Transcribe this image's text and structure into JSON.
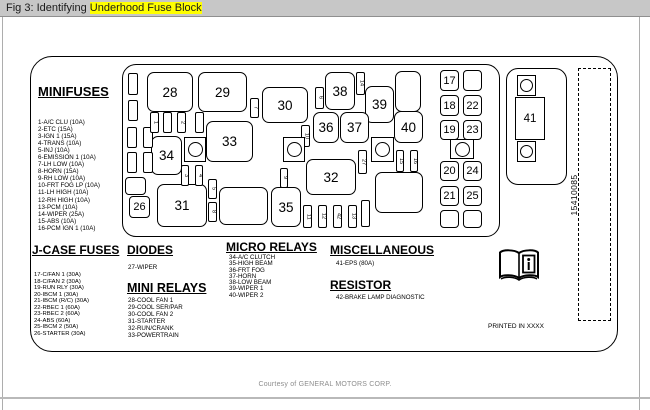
{
  "title_bar": {
    "prefix": "Fig 3: Identifying ",
    "highlight": "Underhood Fuse Block",
    "highlight_color": "#ffff00",
    "bar_color": "#c7c7c7"
  },
  "footer": {
    "courtesy": "Courtesy of GENERAL MOTORS CORP."
  },
  "diagram": {
    "part_number": "15410085",
    "printed_note": "PRINTED IN XXXX",
    "book_icon": "owners-manual-info-icon",
    "stroke_color": "#000000",
    "sections": {
      "minifuses": {
        "heading": "MINIFUSES",
        "items": [
          "1-A/C CLU (10A)",
          "2-ETC (15A)",
          "3-IGN 1 (15A)",
          "4-TRANS (10A)",
          "5-INJ (10A)",
          "6-EMISSION 1 (10A)",
          "7-LH LOW (10A)",
          "8-HORN (15A)",
          "9-RH LOW (10A)",
          "10-FRT FOG LP (10A)",
          "11-LH HIGH (10A)",
          "12-RH HIGH (10A)",
          "13-PCM (10A)",
          "14-WIPER (25A)",
          "15-ABS (10A)",
          "16-PCM IGN 1 (10A)"
        ]
      },
      "jcase": {
        "heading": "J-CASE FUSES",
        "items": [
          "17-C/FAN 1 (30A)",
          "18-C/FAN 2 (30A)",
          "19-RUN RLY (30A)",
          "20-IBCM 1 (30A)",
          "21-IBCM (R/C) (30A)",
          "22-RBEC 1 (60A)",
          "23-RBEC 2 (60A)",
          "24-ABS (60A)",
          "25-IBCM 2 (50A)",
          "26-STARTER (30A)"
        ]
      },
      "diodes": {
        "heading": "DIODES",
        "items": [
          "27-WIPER"
        ]
      },
      "mini_relays": {
        "heading": "MINI RELAYS",
        "items": [
          "28-COOL FAN 1",
          "29-COOL SER/PAR",
          "30-COOL FAN 2",
          "31-STARTER",
          "32-RUN/CRANK",
          "33-POWERTRAIN"
        ]
      },
      "micro_relays": {
        "heading": "MICRO RELAYS",
        "items": [
          "34-A/C CLUTCH",
          "35-HIGH BEAM",
          "36-FRT FOG",
          "37-HORN",
          "38-LOW BEAM",
          "39-WIPER 1",
          "40-WIPER 2"
        ]
      },
      "misc": {
        "heading": "MISCELLANEOUS",
        "items": [
          "41-EPS (80A)"
        ]
      },
      "resistor": {
        "heading": "RESISTOR",
        "items": [
          "42-BRAKE LAMP DIAGNOSTIC"
        ]
      }
    },
    "block": {
      "mega_label": "41",
      "cells": [
        {
          "label": "28",
          "box": [
            147,
            72,
            46,
            40
          ]
        },
        {
          "label": "29",
          "box": [
            198,
            72,
            49,
            40
          ]
        },
        {
          "label": "30",
          "box": [
            262,
            87,
            46,
            36
          ]
        },
        {
          "label": "38",
          "box": [
            325,
            72,
            30,
            38
          ]
        },
        {
          "label": "39",
          "box": [
            365,
            86,
            29,
            37
          ]
        },
        {
          "label": "",
          "box": [
            395,
            71,
            26,
            41
          ]
        },
        {
          "label": "36",
          "box": [
            313,
            112,
            26,
            31
          ]
        },
        {
          "label": "37",
          "box": [
            340,
            112,
            29,
            31
          ]
        },
        {
          "label": "40",
          "box": [
            394,
            111,
            29,
            32
          ]
        },
        {
          "label": "33",
          "box": [
            206,
            121,
            47,
            41
          ]
        },
        {
          "label": "34",
          "box": [
            151,
            136,
            31,
            39
          ]
        },
        {
          "label": "32",
          "box": [
            306,
            159,
            50,
            36
          ]
        },
        {
          "label": "31",
          "box": [
            157,
            184,
            50,
            43
          ]
        },
        {
          "label": "",
          "box": [
            219,
            187,
            49,
            38
          ]
        },
        {
          "label": "35",
          "box": [
            271,
            187,
            30,
            40
          ]
        },
        {
          "label": "",
          "box": [
            375,
            172,
            48,
            41
          ]
        },
        {
          "label": "",
          "box": [
            125,
            177,
            21,
            18
          ],
          "s": 1
        },
        {
          "label": "26",
          "box": [
            129,
            196,
            21,
            22
          ],
          "s": 1
        },
        {
          "label": "17",
          "box": [
            440,
            70,
            19,
            21
          ],
          "s": 1
        },
        {
          "label": "",
          "box": [
            463,
            70,
            19,
            21
          ],
          "s": 1
        },
        {
          "label": "18",
          "box": [
            440,
            95,
            19,
            21
          ],
          "s": 1
        },
        {
          "label": "22",
          "box": [
            463,
            95,
            19,
            21
          ],
          "s": 1
        },
        {
          "label": "19",
          "box": [
            440,
            120,
            19,
            20
          ],
          "s": 1
        },
        {
          "label": "23",
          "box": [
            463,
            120,
            19,
            20
          ],
          "s": 1
        },
        {
          "label": "20",
          "box": [
            440,
            161,
            19,
            20
          ],
          "s": 1
        },
        {
          "label": "24",
          "box": [
            463,
            161,
            19,
            20
          ],
          "s": 1
        },
        {
          "label": "21",
          "box": [
            440,
            186,
            19,
            20
          ],
          "s": 1
        },
        {
          "label": "25",
          "box": [
            463,
            186,
            19,
            20
          ],
          "s": 1
        },
        {
          "label": "",
          "box": [
            440,
            210,
            19,
            18
          ],
          "s": 1
        },
        {
          "label": "",
          "box": [
            463,
            210,
            19,
            18
          ],
          "s": 1
        }
      ],
      "small_fuses": [
        {
          "label": "",
          "box": [
            128,
            73,
            10,
            22
          ]
        },
        {
          "label": "",
          "box": [
            128,
            100,
            10,
            21
          ]
        },
        {
          "label": "",
          "box": [
            127,
            127,
            10,
            21
          ]
        },
        {
          "label": "",
          "box": [
            143,
            127,
            10,
            21
          ]
        },
        {
          "label": "",
          "box": [
            127,
            152,
            10,
            21
          ]
        },
        {
          "label": "",
          "box": [
            143,
            152,
            10,
            21
          ]
        },
        {
          "label": "1",
          "box": [
            150,
            112,
            9,
            21
          ]
        },
        {
          "label": "",
          "box": [
            163,
            112,
            9,
            21
          ]
        },
        {
          "label": "2",
          "box": [
            177,
            112,
            9,
            21
          ]
        },
        {
          "label": "",
          "box": [
            195,
            112,
            9,
            21
          ]
        },
        {
          "label": "7",
          "box": [
            250,
            98,
            9,
            20
          ]
        },
        {
          "label": "6",
          "box": [
            315,
            87,
            9,
            22
          ]
        },
        {
          "label": "14",
          "box": [
            356,
            72,
            9,
            23
          ]
        },
        {
          "label": "10",
          "box": [
            301,
            125,
            9,
            22
          ]
        },
        {
          "label": "3",
          "box": [
            181,
            165,
            8,
            21
          ]
        },
        {
          "label": "4",
          "box": [
            195,
            165,
            8,
            21
          ]
        },
        {
          "label": "5",
          "box": [
            208,
            179,
            9,
            20
          ]
        },
        {
          "label": "8",
          "box": [
            208,
            202,
            9,
            20
          ]
        },
        {
          "label": "9",
          "box": [
            280,
            168,
            8,
            20
          ]
        },
        {
          "label": "27",
          "box": [
            358,
            150,
            9,
            24
          ]
        },
        {
          "label": "15",
          "box": [
            396,
            150,
            8,
            22
          ]
        },
        {
          "label": "16",
          "box": [
            410,
            150,
            8,
            22
          ]
        },
        {
          "label": "11",
          "box": [
            303,
            205,
            9,
            23
          ]
        },
        {
          "label": "12",
          "box": [
            318,
            205,
            9,
            23
          ]
        },
        {
          "label": "42",
          "box": [
            333,
            205,
            9,
            23
          ]
        },
        {
          "label": "13",
          "box": [
            348,
            205,
            9,
            23
          ]
        },
        {
          "label": "",
          "box": [
            361,
            200,
            9,
            27
          ]
        }
      ],
      "posts": [
        [
          184,
          137,
          22,
          25
        ],
        [
          283,
          137,
          22,
          25
        ],
        [
          371,
          137,
          23,
          25
        ],
        [
          450,
          139,
          24,
          20
        ]
      ]
    }
  }
}
